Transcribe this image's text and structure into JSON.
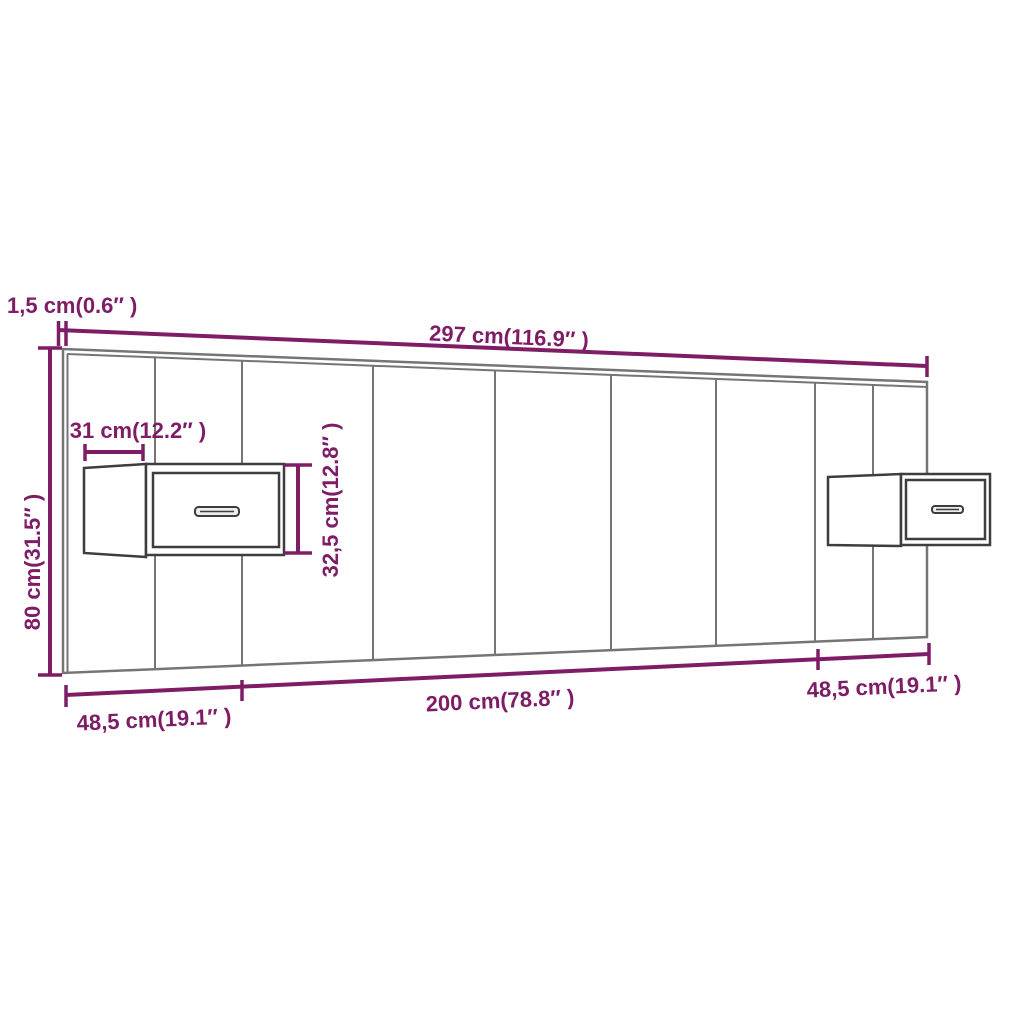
{
  "diagram": {
    "dimensions": {
      "thickness": "1,5 cm(0.6″ )",
      "total_width": "297 cm(116.9″ )",
      "height": "80 cm(31.5″ )",
      "cabinet_depth": "31 cm(12.2″ )",
      "cabinet_height": "32,5 cm(12.8″ )",
      "left_section": "48,5 cm(19.1″ )",
      "center_section": "200 cm(78.8″ )",
      "right_section": "48,5 cm(19.1″ )"
    },
    "colors": {
      "dimension": "#7e1d66",
      "board_line": "#757575",
      "cabinet_line": "#3d3d3d",
      "background": "#ffffff"
    }
  }
}
